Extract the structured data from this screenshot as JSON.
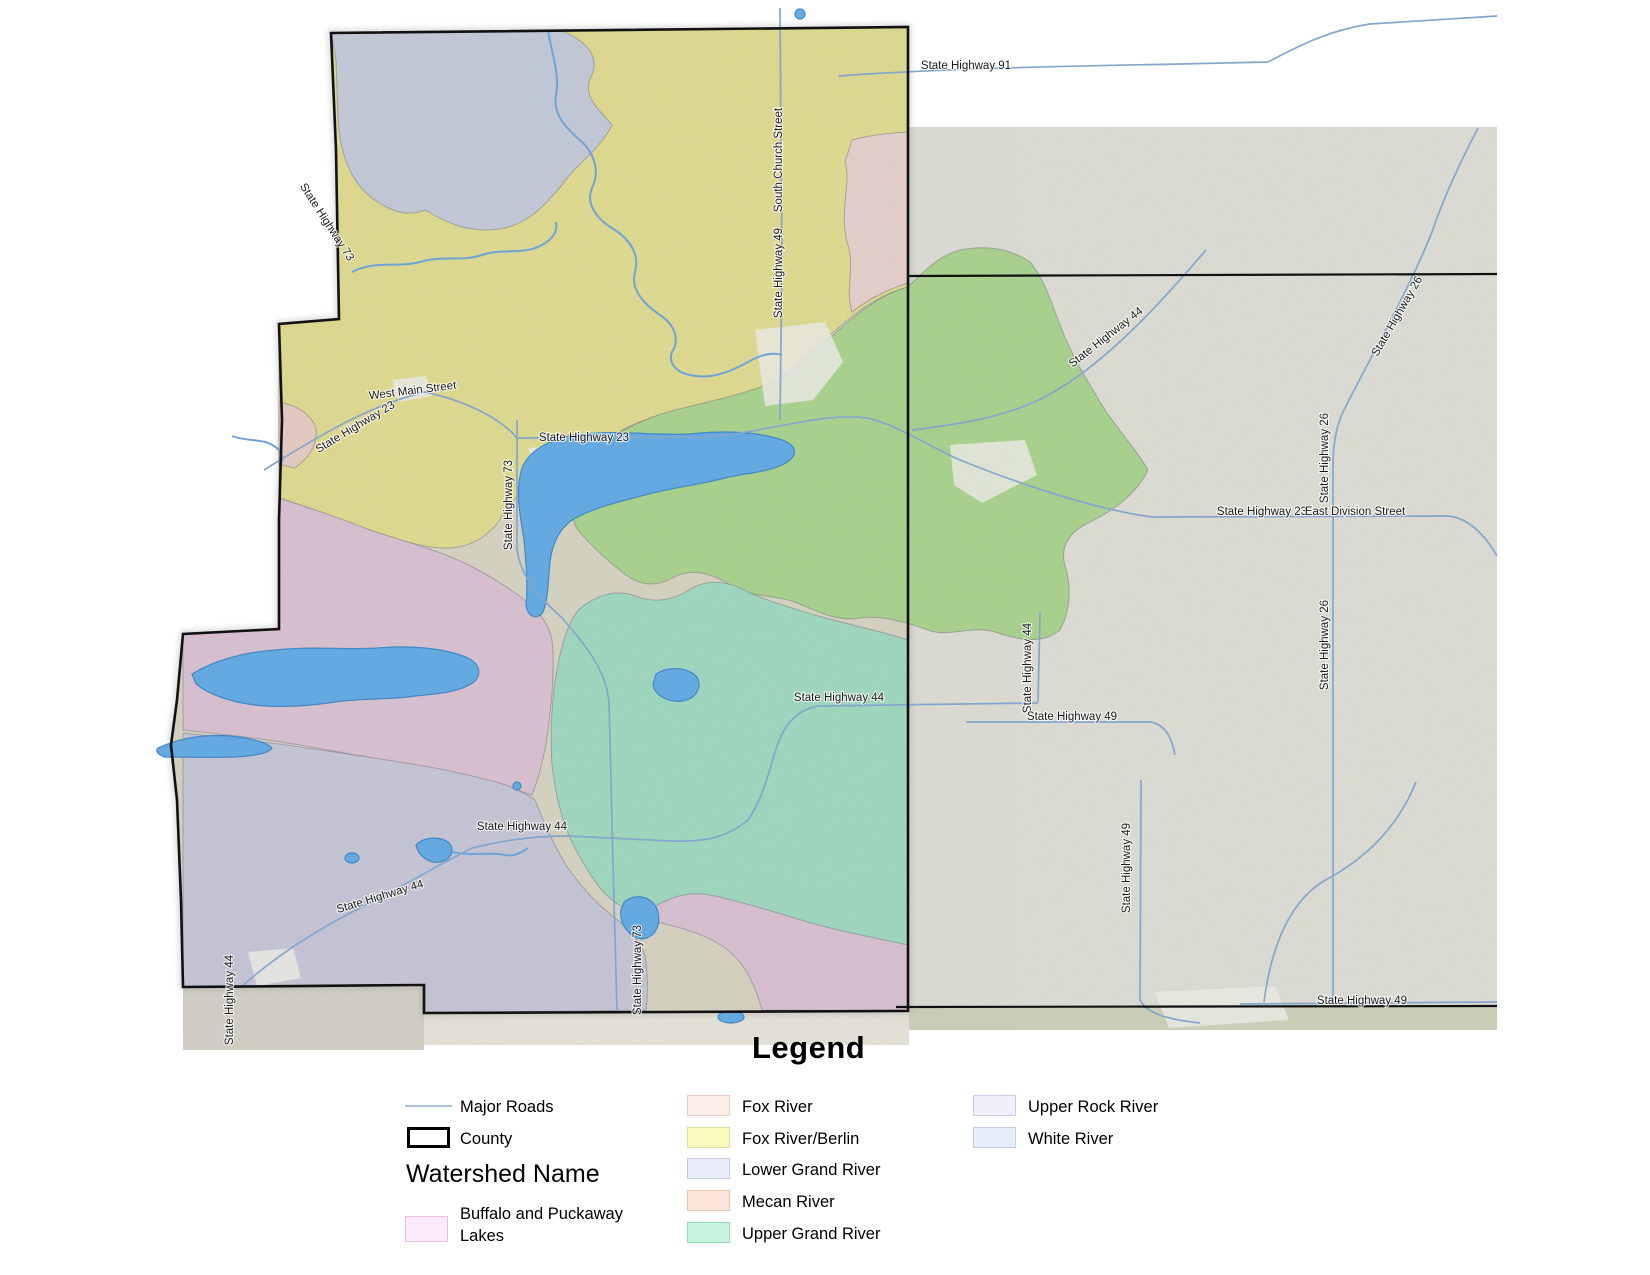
{
  "map": {
    "colors": {
      "county_border": "#111111",
      "road": "#84a6cc",
      "river": "#6fa3d6",
      "lake_fill": "#64a9e0",
      "lake_border": "#4388c4",
      "satellite_right": "#dadad2",
      "satellite_tan": "#d3d0bf",
      "satellite_below_left": "#d0cec2",
      "satellite_below_mid": "#e3e1d6",
      "satellite_green_strip": "#c9ceb7",
      "region_fox_river_berlin": "#dcd88f",
      "region_white_river": "#c1c7d5",
      "region_fox_river": "#e3cdc9",
      "region_mecan_river": "#e2c9c0",
      "region_green": "#a8d08c",
      "region_upper_grand": "#9ed5bd",
      "region_buffalo_puckaway": "#d6bfcf",
      "region_lower_grand": "#c3c3d3",
      "urban": "#e9e9e2",
      "label": "#1c1c1c"
    },
    "labels": [
      {
        "id": "hw91",
        "text": "State Highway 91",
        "x": 966,
        "y": 69,
        "rot": 0
      },
      {
        "id": "south-church-street",
        "text": "South Church Street",
        "x": 782,
        "y": 160,
        "rot": -90
      },
      {
        "id": "hw49-north",
        "text": "State Highway 49",
        "x": 782,
        "y": 273,
        "rot": -90
      },
      {
        "id": "hw73-northwest",
        "text": "State Highway 73",
        "x": 324,
        "y": 224,
        "rot": 57
      },
      {
        "id": "west-main-street",
        "text": "West Main Street",
        "x": 413,
        "y": 394,
        "rot": -7
      },
      {
        "id": "hw23-diagonal",
        "text": "State Highway 23",
        "x": 357,
        "y": 430,
        "rot": -31
      },
      {
        "id": "hw23-central",
        "text": "State Highway 23",
        "x": 584,
        "y": 441,
        "rot": 0
      },
      {
        "id": "hw73-central",
        "text": "State Highway 73",
        "x": 512,
        "y": 505,
        "rot": -90
      },
      {
        "id": "hw44-northeast",
        "text": "State Highway 44",
        "x": 1108,
        "y": 340,
        "rot": -38
      },
      {
        "id": "hw26-northeast",
        "text": "State Highway 26",
        "x": 1400,
        "y": 318,
        "rot": -60
      },
      {
        "id": "hw26-upper",
        "text": "State Highway 26",
        "x": 1328,
        "y": 458,
        "rot": -90
      },
      {
        "id": "hw23-east",
        "text": "State Highway 23",
        "x": 1262,
        "y": 515,
        "rot": 0
      },
      {
        "id": "east-division-street",
        "text": "East Division Street",
        "x": 1355,
        "y": 515,
        "rot": 0
      },
      {
        "id": "hw26-lower",
        "text": "State Highway 26",
        "x": 1328,
        "y": 645,
        "rot": -90
      },
      {
        "id": "hw44-central",
        "text": "State Highway 44",
        "x": 839,
        "y": 701,
        "rot": 0
      },
      {
        "id": "hw44-vertical",
        "text": "State Highway 44",
        "x": 1031,
        "y": 668,
        "rot": -90
      },
      {
        "id": "hw49-central",
        "text": "State Highway 49",
        "x": 1072,
        "y": 720,
        "rot": 0
      },
      {
        "id": "hw44-south",
        "text": "State Highway 44",
        "x": 522,
        "y": 830,
        "rot": 0
      },
      {
        "id": "hw44-southwest",
        "text": "State Highway 44",
        "x": 381,
        "y": 900,
        "rot": -17
      },
      {
        "id": "hw49-south-vertical",
        "text": "State Highway 49",
        "x": 1130,
        "y": 868,
        "rot": -90
      },
      {
        "id": "hw73-south",
        "text": "State Highway 73",
        "x": 641,
        "y": 970,
        "rot": -90
      },
      {
        "id": "hw44-far-southwest",
        "text": "State Highway 44",
        "x": 233,
        "y": 1000,
        "rot": -90
      },
      {
        "id": "hw49-southeast",
        "text": "State Highway 49",
        "x": 1362,
        "y": 1004,
        "rot": 0
      }
    ]
  },
  "legend": {
    "title": "Legend",
    "major_roads_label": "Major Roads",
    "major_roads_color": "#a9c2da",
    "county_label": "County",
    "watershed_heading": "Watershed Name",
    "watersheds": [
      {
        "id": "buffalo-puckaway",
        "label": "Buffalo and Puckaway Lakes",
        "fill": "#fdeafa",
        "border": "#edbfdf"
      },
      {
        "id": "fox-river",
        "label": "Fox River",
        "fill": "#fdeeea",
        "border": "#eec8c0"
      },
      {
        "id": "fox-river-berlin",
        "label": "Fox River/Berlin",
        "fill": "#fafabe",
        "border": "#dcdc96"
      },
      {
        "id": "lower-grand-river",
        "label": "Lower Grand River",
        "fill": "#e9ecf8",
        "border": "#c4cbe7"
      },
      {
        "id": "mecan-river",
        "label": "Mecan River",
        "fill": "#fbe4d9",
        "border": "#eec2ab"
      },
      {
        "id": "upper-grand-river",
        "label": "Upper Grand River",
        "fill": "#c9f3de",
        "border": "#8fdcb6"
      },
      {
        "id": "upper-rock-river",
        "label": "Upper Rock River",
        "fill": "#f1edfb",
        "border": "#d2c8ef"
      },
      {
        "id": "white-river",
        "label": "White River",
        "fill": "#e7edf9",
        "border": "#c0cfe8"
      }
    ]
  }
}
